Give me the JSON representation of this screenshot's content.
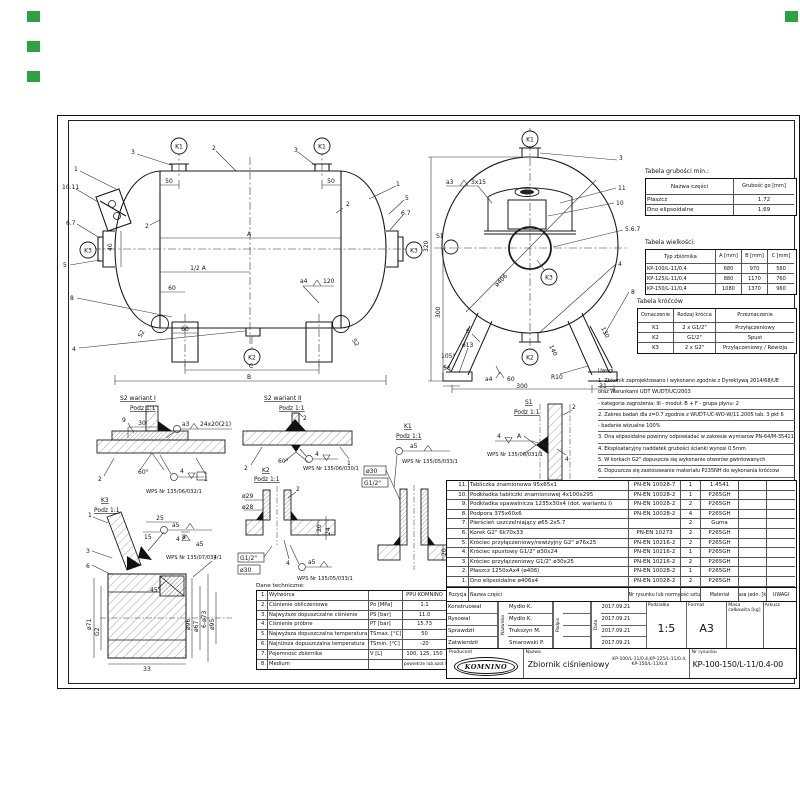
{
  "markers": {
    "color": "#2fa043"
  },
  "tables": {
    "grubosci": {
      "title": "Tabela grubości min.:",
      "headers": [
        "Nazwa części",
        "Grubość go [mm]"
      ],
      "rows": [
        [
          "Płaszcz",
          "1.72"
        ],
        [
          "Dno elipsoidalne",
          "1.69"
        ]
      ]
    },
    "wielkosci": {
      "title": "Tabela wielkości:",
      "headers": [
        "Typ zbiornika",
        "A [mm]",
        "B [mm]",
        "C [mm]"
      ],
      "rows": [
        [
          "KP-100/L-11/0,4",
          "680",
          "970",
          "560"
        ],
        [
          "KP-125/L-11/0,4",
          "880",
          "1170",
          "760"
        ],
        [
          "KP-150/L-11/0,4",
          "1080",
          "1370",
          "960"
        ]
      ]
    },
    "krocce": {
      "title": "Tabela króćców",
      "headers": [
        "Oznaczenie",
        "Rodzaj króćca",
        "Przeznaczenie"
      ],
      "rows": [
        [
          "K1",
          "2 x G1/2\"",
          "Przyłączeniowy"
        ],
        [
          "K2",
          "G1/2\"",
          "Spust"
        ],
        [
          "K3",
          "2 x G2\"",
          "Przyłączeniowy / Rewizja"
        ]
      ]
    }
  },
  "uwagi": {
    "title": "Uwagi:",
    "lines": [
      "1. Zbiornik zaprojektowano i wykonano zgodnie z Dyrektywą 2014/68/UE",
      "oraz Warunkami UDT WUDT/UC/2003",
      "- kategoria zagrożenia: III   - moduł: B + F   - grupa płynu: 2",
      "2. Zakres badań dla z=0.7 zgodnie z WUDT-UC-WO-W/11.2005 tab. 3 pkt 6",
      "- badanie wizualne 100%",
      "3. Dna elipsoidalne powinny odpowiadać w zakresie wymiarów PN-64/M-35411",
      "4. Eksploatacyjny naddatek grubości ścianki wynosi 0.5mm",
      "5. W korkach G2\" dopuszcza się wykonanie otworów gwintowanych",
      "6. Dopuszcza się zastosowanie materiału P235NH do wykonania króćców",
      "oraz P265GH do wykonania podstawy tabliczki fabrycznej i podpór"
    ]
  },
  "bom": {
    "headers": {
      "pos": "Pozycja",
      "name": "Nazwa części",
      "norm": "Nr rysunku lub normy",
      "qty": "Ilość sztuk",
      "material": "Materiał",
      "mass": "Masa jedn. [kg]",
      "remarks": "UWAGI"
    },
    "rows": [
      {
        "pos": "11.",
        "name": "Tabliczka znamionowa 95x65x1",
        "norm": "PN-EN 10028-7",
        "qty": "1",
        "material": "1.4541"
      },
      {
        "pos": "10.",
        "name": "Podkładka tabliczki znamionowej 4x100x295",
        "norm": "PN-EN 10028-2",
        "qty": "1",
        "material": "P265GH"
      },
      {
        "pos": "9.",
        "name": "Podkładka spawalnicza 1235x30x4 (dot. wariantu I)",
        "norm": "PN-EN 10028-2",
        "qty": "2",
        "material": "P265GH"
      },
      {
        "pos": "8.",
        "name": "Podpora 375x60x6",
        "norm": "PN-EN 10028-2",
        "qty": "4",
        "material": "P265GH"
      },
      {
        "pos": "7.",
        "name": "Pierścień uszczelniający ø65.2x5.7",
        "norm": "",
        "qty": "2",
        "material": "Guma"
      },
      {
        "pos": "6.",
        "name": "Korek G2\" 6k70x33",
        "norm": "PN-EN 10273",
        "qty": "2",
        "material": "P265GH"
      },
      {
        "pos": "5.",
        "name": "Króciec przyłączeniowy/rewizyjny G2\" ø76x25",
        "norm": "PN-EN 10216-2",
        "qty": "2",
        "material": "P265GH"
      },
      {
        "pos": "4.",
        "name": "Króciec spustowy G1/2\" ø30x24",
        "norm": "PN-EN 10216-2",
        "qty": "1",
        "material": "P265GH"
      },
      {
        "pos": "3.",
        "name": "Króciec przyłączeniowy G1/2\" ø30x25",
        "norm": "PN-EN 10216-2",
        "qty": "2",
        "material": "P265GH"
      },
      {
        "pos": "2.",
        "name": "Płaszcz 1250xAx4 (ø406)",
        "norm": "PN-EN 10028-2",
        "qty": "1",
        "material": "P265GH"
      },
      {
        "pos": "1.",
        "name": "Dno elipsoidalne ø406x4",
        "norm": "PN-EN 10028-2",
        "qty": "2",
        "material": "P265GH"
      }
    ]
  },
  "dane": {
    "title": "Dane techniczne:",
    "rows": [
      {
        "no": "1.",
        "label": "Wytwórca",
        "sym": "",
        "value": "PPU KOMNINO"
      },
      {
        "no": "2.",
        "label": "Ciśnienie obliczeniowe",
        "sym": "Po [MPa]",
        "value": "1.1"
      },
      {
        "no": "3.",
        "label": "Najwyższe dopuszczalne ciśnienie",
        "sym": "PS [bar]",
        "value": "11.0"
      },
      {
        "no": "4.",
        "label": "Ciśnienie próbne",
        "sym": "PT [bar]",
        "value": "15.73"
      },
      {
        "no": "5.",
        "label": "Najwyższa dopuszczalna temperatura",
        "sym": "TSmax. [°C]",
        "value": "50"
      },
      {
        "no": "6.",
        "label": "Najniższa dopuszczalna temperatura",
        "sym": "TSmin. [°C]",
        "value": "-20"
      },
      {
        "no": "7.",
        "label": "Pojemność zbiornika",
        "sym": "V [L]",
        "value": "100, 125, 150"
      },
      {
        "no": "8.",
        "label": "Medium",
        "sym": "",
        "value": "powietrze lub azot lub argon"
      }
    ]
  },
  "titleblock": {
    "col_name": "Nazwisko",
    "col_sign": "Podpis",
    "col_date": "Data",
    "roles": [
      {
        "role": "Konstruował",
        "name": "Mydło K.",
        "date": "2017.09.21"
      },
      {
        "role": "Rysował",
        "name": "Mydło K.",
        "date": "2017.09.21"
      },
      {
        "role": "Sprawdził",
        "name": "Trukszyn M.",
        "date": "2017.09.21"
      },
      {
        "role": "Zatwierdził",
        "name": "Smarowski P.",
        "date": "2017.09.21"
      }
    ],
    "scale_label": "Podziałka",
    "scale": "1:5",
    "format_label": "Format",
    "format": "A3",
    "mass_label": "Masa całkowita [kg]",
    "sheet_label": "Arkusz",
    "producer_label": "Producent",
    "producer": "KOMNINO",
    "name_label": "Nazwa",
    "name": "Zbiornik ciśnieniowy",
    "variants_l1": "KP-100/L-11/0.4,KP-125/L-11/0.4,",
    "variants_l2": "KP-150/L-11/0.4",
    "drawing_no_label": "Nr rysunku",
    "drawing_no": "KP-100-150/L-11/0.4-00"
  },
  "ann": {
    "side": {
      "b1": "1",
      "b3": "3",
      "k1": "K1",
      "b2": "2",
      "b3r": "3",
      "k1r": "K1",
      "b1r": "1",
      "b5r": "5",
      "b67r": "6.7",
      "k3r": "K3",
      "b1011": "10.11",
      "b67": "6.7",
      "k3": "K3",
      "b5": "5",
      "b8": "8",
      "b4": "4",
      "k2": "K2",
      "d50l": "50",
      "d50r": "50",
      "t2l": "2",
      "t2r": "2",
      "dA": "A",
      "dHalf": "1/2 A",
      "d60a": "60",
      "d60b": "60",
      "dC": "C",
      "dB": "B",
      "wa4": "a4",
      "w120": "120",
      "d40": "40",
      "s2l": "S2",
      "s2r": "S2"
    },
    "end": {
      "k1": "K1",
      "k2": "K2",
      "k3": "K3",
      "b3": "3",
      "b11": "11",
      "b10": "10",
      "b567": "5.6.7",
      "b4": "4",
      "b8": "8",
      "b6": "6",
      "wa3": "a3",
      "w3x15": "3x15",
      "s1": "S1",
      "d406": "ø406",
      "d320": "320",
      "d300v": "300",
      "d300h": "300",
      "d31": "31",
      "d13": "ø13",
      "d105": "105°",
      "d56": "56",
      "wa4": "a4",
      "w60": "60",
      "r10": "R10",
      "d140": "140",
      "d130": "130"
    },
    "det": {
      "w1t": "S2 wariant I",
      "w1s": "Podz 1:1",
      "w1_9": "9",
      "w1_30": "30",
      "w1_a3": "a3",
      "w1_24": "24x20(21)",
      "w1_60": "60°",
      "w1_4": "4",
      "w1_2": "2",
      "w1_1": "1",
      "w1_wps": "WPS Nr 135/06/032/1",
      "w2t": "S2 wariant II",
      "w2s": "Podz 1:1",
      "w2_2t": "2",
      "w2_2": "2",
      "w2_1": "1",
      "w2_60": "60°",
      "w2_4": "4",
      "w2_wps": "WPS Nr 135/06/030/1",
      "k2t": "K2",
      "k2s": "Podz 1:1",
      "k2_29": "ø29",
      "k2_28": "ø28",
      "k2_2": "2",
      "k2_20": "20",
      "k2_24": "24",
      "k2_g": "G1/2\"",
      "k2_30": "ø30",
      "k2_4": "4",
      "k2_a5": "a5",
      "k2_wps": "WPS Nr 135/05/033/1",
      "k1t": "K1",
      "k1s": "Podz 1:1",
      "k1_a5": "a5",
      "k1_wps": "WPS Nr 135/05/033/1",
      "k1_30": "ø30",
      "k1_g": "G1/2\"",
      "k1_20": "20",
      "k1_24": "24",
      "s1t": "S1",
      "s1s": "Podz 1:1",
      "s1_2": "2",
      "s1_4": "4",
      "s1_A": "A",
      "s1_4r": "4",
      "s1_wps": "WPS Nr 135/06/031/1",
      "k3t": "K3",
      "k3s": "Podz 1:1",
      "k3_1": "1",
      "k3_3": "3",
      "k3_6": "6",
      "k3_7": "7",
      "k3_25": "25",
      "k3_15": "15",
      "k3_8": "8",
      "k3_45": "45°",
      "k3_a5a": "a5",
      "k3_4": "4",
      "k3_a5b": "a5",
      "k3_wps": "WPS Nr 135/07/034/1",
      "k3_71": "ø71",
      "k3_g2": "G2",
      "k3_33": "33",
      "k3_96": "ø96",
      "k3_67": "ø67",
      "k3_73": "6-ø73",
      "k3_95": "ø95"
    }
  }
}
